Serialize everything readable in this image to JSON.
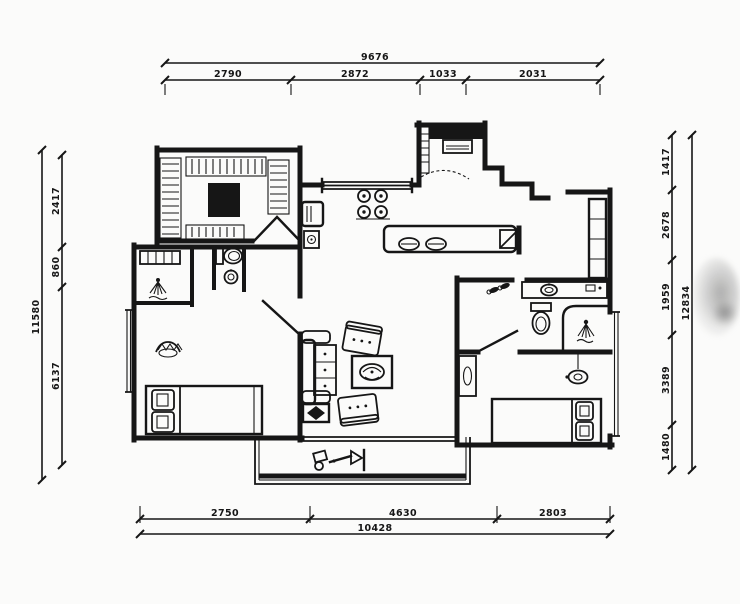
{
  "colors": {
    "ink": "#161616",
    "paper": "#fbfbfa"
  },
  "dimensions": {
    "top": {
      "total": "9676",
      "segments": [
        "2790",
        "2872",
        "1033",
        "2031"
      ]
    },
    "bottom": {
      "total": "10428",
      "segments": [
        "2750",
        "4630",
        "2803"
      ]
    },
    "left": {
      "total": "11580",
      "segments": [
        "2417",
        "860",
        "6137"
      ]
    },
    "right": {
      "total": "12834",
      "segments": [
        "1417",
        "2678",
        "1959",
        "3389",
        "1480"
      ]
    }
  },
  "icons": [
    "wardrobe-hatch-icon",
    "closet-island-icon",
    "double-door-icon",
    "fridge-icon",
    "water-heater-icon",
    "stove-icon",
    "window-icon",
    "washing-machine-icon",
    "sliding-door-arc-icon",
    "dining-plates-icon",
    "tall-cabinet-icon",
    "corner-shelf-icon",
    "slippers-icon",
    "vanity-sink-icon",
    "toilet-icon",
    "shower-spray-icon",
    "plant-icon",
    "ceiling-lamp-icon",
    "sofa-icon",
    "armchair-icon",
    "coffee-table-icon",
    "side-table-icon",
    "bed-icon",
    "pillow-icon",
    "balcony-equipment-icon",
    "door-leaf-icon"
  ]
}
